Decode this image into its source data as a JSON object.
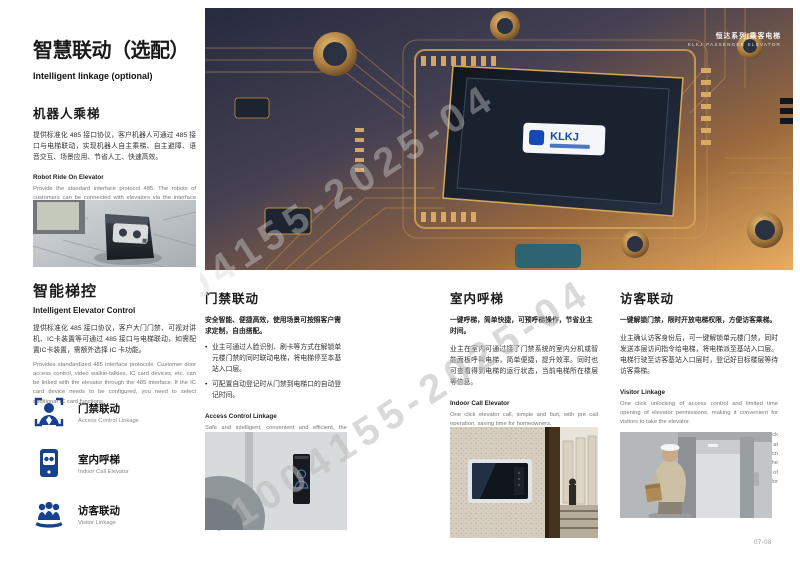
{
  "page": {
    "number": "07-08",
    "watermark": "1004155-2025-04",
    "accent_blue": "#16418e"
  },
  "hero": {
    "series_cn": "恒达系列|乘客电梯",
    "series_en": "KLKJ PASSENGER ELEVATOR",
    "chip_logo": "KLKJ"
  },
  "left": {
    "title_cn": "智慧联动（选配）",
    "title_en": "Intelligent linkage (optional)",
    "robot": {
      "heading_cn": "机器人乘梯",
      "body_cn": "提供标准化 485 接口协议，客户机器人可通过 485 接口与电梯联动，实现机器人自主乘梯、自主避障、语音交互、场景应用、节省人工、快速高效。",
      "heading_en": "Robot Ride On Elevator",
      "body_en": "Provide the standard interface protocol 485. The robots of customers can be connected with elevators via the interface 485, autonomous elevator ride, autonomous obstacle avoidance, voice interaction, scene application, saving labor, fast and efficient."
    },
    "control": {
      "heading_cn": "智能梯控",
      "heading_en": "Intelligent Elevator Control",
      "body_cn": "提供标准化 485 接口协议，客户大门门禁、可视对讲机、IC卡装置等可通过 485 接口与电梯联动，如需配置IC卡装置，需额外选择 IC 卡功能。",
      "body_en": "Provides standardized 485 interface protocols. Customer door access control, video walkie-talkies, IC card devices, etc. can be linked with the elevator through the 485 interface. If the IC card device needs to be configured, you need to select additional IC card functions."
    },
    "features": [
      {
        "icon": "face-recognition-icon",
        "label_cn": "门禁联动",
        "label_en": "Access Control Linkage"
      },
      {
        "icon": "intercom-tablet-icon",
        "label_cn": "室内呼梯",
        "label_en": "Indoor Call Elevator"
      },
      {
        "icon": "visitors-group-icon",
        "label_cn": "访客联动",
        "label_en": "Visitor Linkage"
      }
    ]
  },
  "columns": [
    {
      "heading_cn": "门禁联动",
      "intro_cn": "安全智能、便捷高效，使用场景可按照客户需求定制，自由搭配。",
      "bullets_cn": [
        "业主可通过人脸识别、刷卡等方式在解锁单元楼门禁的同时联动电梯，将电梯停至本基站入口层。",
        "可配置自动登记时从门禁到电梯口的自动登记时间。"
      ],
      "heading_en": "Access Control Linkage",
      "intro_en": "Safe and intelligent, convenient and efficient, the usage scenario can be customized according to customer needs, and can be freely adjusted.",
      "bullets_en": [
        "Owners can unlock the elevator at the same time as unlocking the access control of the unit building through facial recognition, card swiping, and other methods, and call the elevator to the entrance level of this base station.",
        "Configure the automatic registration time from access control to elevator entrance during automatic registration."
      ]
    },
    {
      "heading_cn": "室内呼梯",
      "intro_cn": "一键呼梯，简单快捷，可预呼梯操作，节省业主时间。",
      "body_cn": "业主在室内可通过接了门禁系统的室内分机或智能面板呼叫电梯，简单便捷，提升效率。同时也可查看得到电梯的运行状态，当前电梯所在楼层等信息。",
      "heading_en": "Indoor Call Elevator",
      "intro_en": "One click elevator call, simple and fast, with pre call operation, saving time for homeowners.",
      "body_en": "Owners can call the elevator indoors by pressing the indoor extension or intelligent panel of the access control system, which is simple, convenient, and improves efficiency. At the same time, they can also view the operating status of the elevator, the current floor where the elevator is located, and other information."
    },
    {
      "heading_cn": "访客联动",
      "intro_cn": "一键解锁门禁，限时开放电梯权限，方便访客乘梯。",
      "body_cn": "业主确认访客身份后，可一键解锁单元楼门禁，同时发送本层访问指令给电梯，将电梯派至基站入口层。电梯行驶至访客基站入口层时，登记好目标楼层等待访客乘梯。",
      "heading_en": "Visitor Linkage",
      "intro_en": "One click unlocking of access control and limited time opening of elevator permissions, making it convenient for visitors to take the elevator.",
      "body_en": "After the owner confirms the visitor's identity, they can unlock the access control of the unit building with one click, and at the same time send the visitor instructions to the elevator on this floor to dispatch the elevator to the entrance level of the base station. After the elevator reaches the entrance level of the visitor base station, register the target floor and wait for the visitor to board."
    }
  ]
}
